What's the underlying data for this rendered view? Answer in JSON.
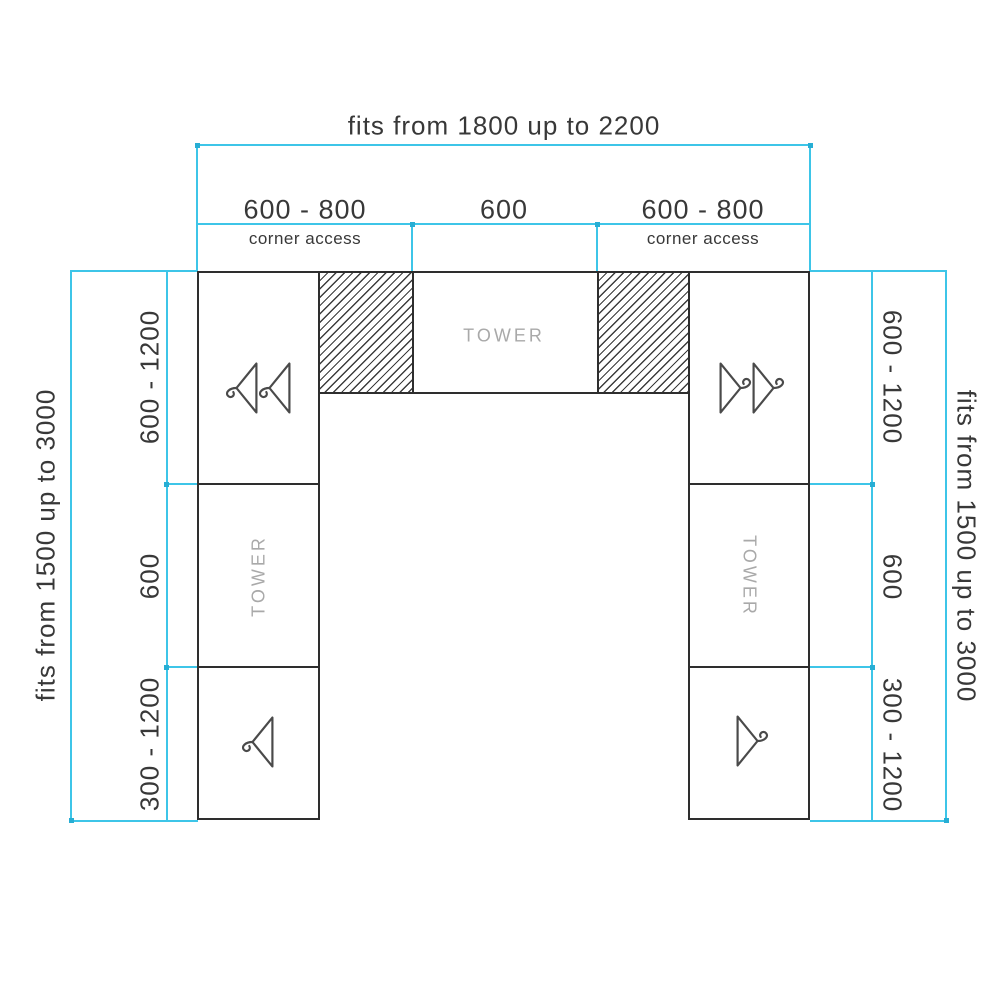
{
  "top_dimension": {
    "overall": "fits from 1800 up to 2200",
    "sections": [
      {
        "size": "600 - 800",
        "note": "corner access"
      },
      {
        "size": "600",
        "note": ""
      },
      {
        "size": "600 - 800",
        "note": "corner access"
      }
    ]
  },
  "left_dimension": {
    "overall": "fits from 1500 up to 3000",
    "sections": [
      {
        "size": "600 - 1200"
      },
      {
        "size": "600"
      },
      {
        "size": "300 - 1200"
      }
    ]
  },
  "right_dimension": {
    "overall": "fits from 1500 up to 3000",
    "sections": [
      {
        "size": "600 - 1200"
      },
      {
        "size": "600"
      },
      {
        "size": "300 - 1200"
      }
    ]
  },
  "units": {
    "center_tower": "TOWER",
    "left_tower": "TOWER",
    "right_tower": "TOWER"
  },
  "icons": {
    "hanger": "clothes-hanger-icon",
    "hatch": "corner-fill-hatch"
  },
  "colors": {
    "dimension_line": "#3dc5e8",
    "structure_line": "#2e2e2e",
    "tower_text": "#a9a9a9",
    "hatch_line": "#3c3c3c",
    "text": "#383838"
  }
}
